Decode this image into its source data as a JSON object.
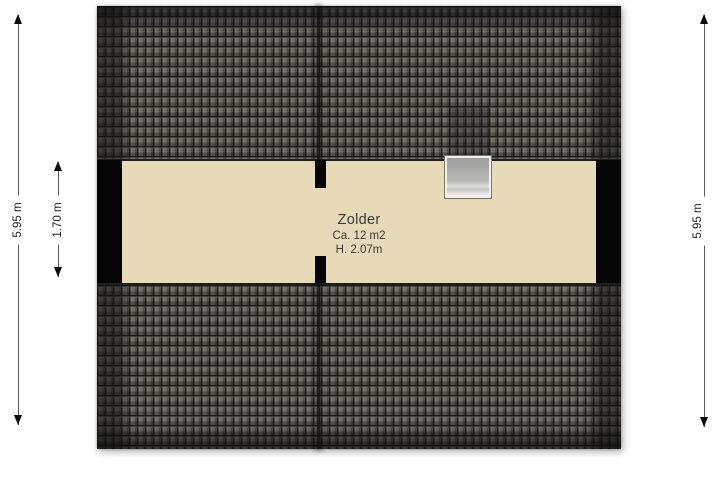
{
  "floorplan": {
    "room": {
      "name": "Zolder",
      "area": "Ca. 12 m2",
      "ceiling_height": "H. 2.07m"
    },
    "dimensions": {
      "left_outer": "5.95 m",
      "left_inner": "1.70 m",
      "right": "5.95 m"
    },
    "features": {
      "skylight": "skylight-window",
      "roof_sections": 2,
      "roof_divider": "center ridge seam"
    },
    "colors": {
      "floor": "#e7dab8",
      "roof_tile": "#6d6b64",
      "roof_edge": "#2b2b29",
      "wall": "#060606",
      "window_frame": "#b3b3b1",
      "dimension_line": "#5a5a5a",
      "background": "#ffffff"
    }
  }
}
